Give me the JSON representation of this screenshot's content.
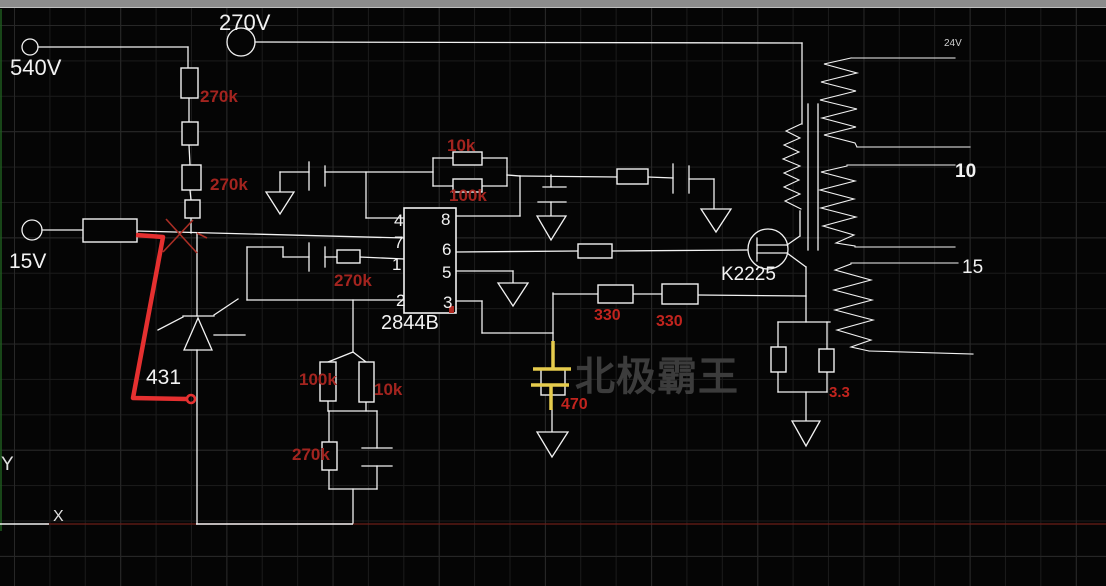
{
  "window": {
    "top_bar": "title-bar-sliver"
  },
  "schematic": {
    "power_labels": {
      "v540": "540V",
      "v270": "270V",
      "v15": "15V"
    },
    "ic": {
      "part": "2844B",
      "pins_left": [
        "4",
        "7",
        "1",
        "2"
      ],
      "pins_right": [
        "8",
        "6",
        "5",
        "3"
      ]
    },
    "components": {
      "r_chain_top": "270k",
      "r_chain_mid": "270k",
      "rt_10k": "10k",
      "rt_100k": "100k",
      "r_fb": "270k",
      "r_div_100k": "100k",
      "r_div_10k": "10k",
      "r_div_270k": "270k",
      "r_330_a": "330",
      "r_330_b": "330",
      "c_470": "470",
      "r_sense": "3.3",
      "mosfet": "K2225",
      "shunt_reg": "431"
    },
    "transformer_taps": {
      "tap_24v": "24V",
      "tap_10": "10",
      "tap_15": "15"
    },
    "watermark": "北极霸王",
    "ucs": {
      "x_label": "X",
      "y_label": "Y"
    }
  },
  "colors": {
    "wire_white": "#f2f2f2",
    "label_red": "#a3241f",
    "bright_label_red": "#c1241e",
    "annotation_red": "#e53030",
    "cap_yellow": "#e6cc4d",
    "bus_dark_red": "#6b1d18",
    "watermark_gray": "#3c3c3c",
    "grid": "#1b1b1b",
    "top_bar": "#8c8c8c",
    "ucs_green": "#1e5c1e"
  }
}
